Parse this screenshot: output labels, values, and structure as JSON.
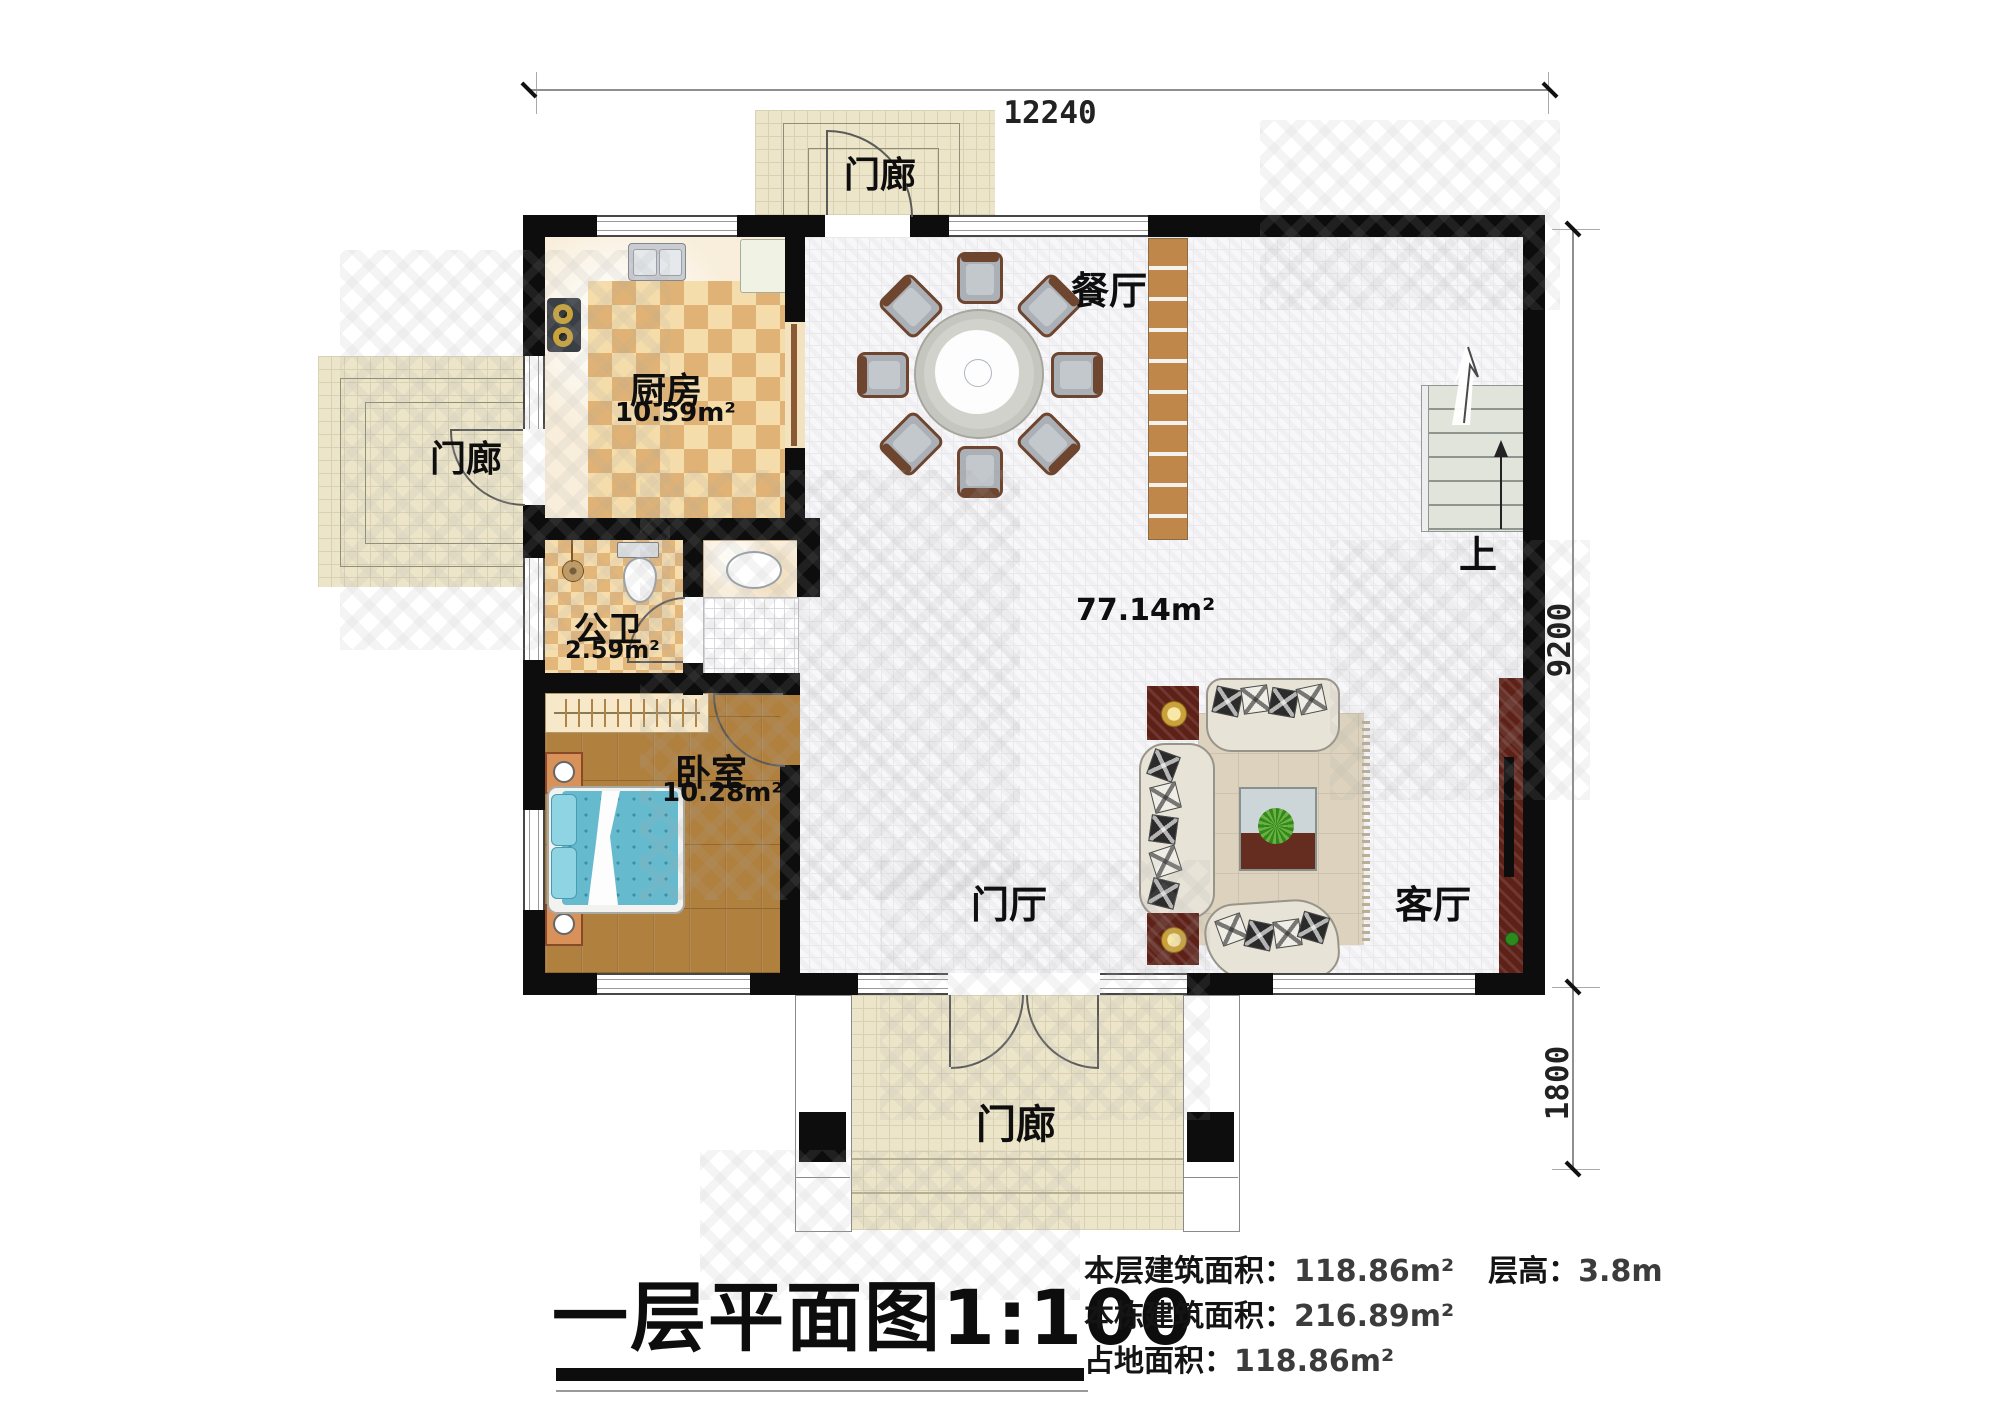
{
  "drawing": {
    "title": "一层平面图1:100",
    "info": {
      "floor_area_label": "本层建筑面积：",
      "floor_area_value": "118.86m²",
      "floor_height_label": "层高：",
      "floor_height_value": "3.8m",
      "building_area_label": "本栋建筑面积：",
      "building_area_value": "216.89m²",
      "footprint_label": "占地面积：",
      "footprint_value": "118.86m²"
    },
    "dimensions": {
      "top_width": "12240",
      "right_height": "9200",
      "porch_depth": "1800"
    },
    "rooms": {
      "kitchen": {
        "name": "厨房",
        "area": "10.59m²"
      },
      "dining": {
        "name": "餐厅"
      },
      "bathroom": {
        "name": "公卫",
        "area": "2.59m²"
      },
      "bedroom": {
        "name": "卧室",
        "area": "10.28m²"
      },
      "hall": {
        "name": "门厅",
        "area": "77.14m²"
      },
      "living": {
        "name": "客厅"
      },
      "stairs": {
        "direction": "上"
      },
      "porch_top": {
        "name": "门廊"
      },
      "porch_left": {
        "name": "门廊"
      },
      "porch_bottom": {
        "name": "门廊"
      }
    },
    "colors": {
      "wall": "#0d0d0d",
      "kitchen_tile_dark": "#e0b275",
      "kitchen_tile_light": "#f4dcab",
      "wood_floor": "#b0803f",
      "porch_tile": "#ede5ca",
      "hall_tile": "#f7f7f9",
      "bed_quilt": "#66bace",
      "cabinet_wood": "#c0874b"
    }
  }
}
